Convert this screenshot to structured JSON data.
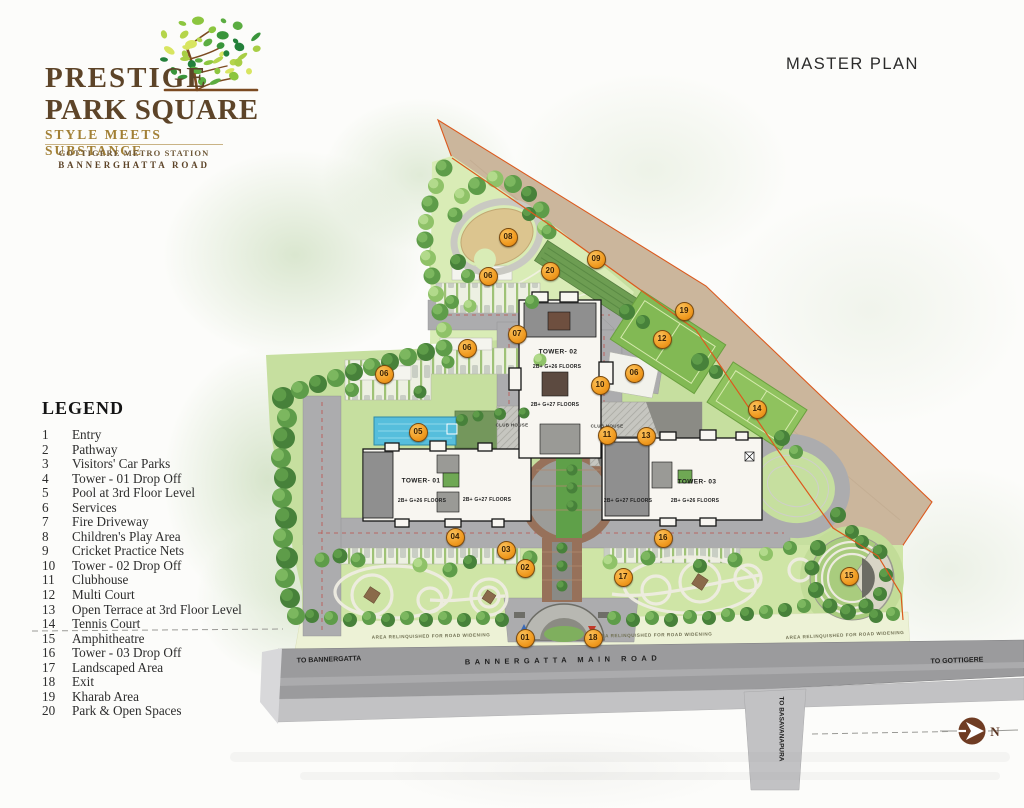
{
  "brand": {
    "line1": "PRESTIGE",
    "line2": "PARK SQUARE",
    "tagline": "STYLE MEETS SUBSTANCE",
    "sub1": "GOTTIGERE METRO STATION",
    "sub2": "BANNERGHATTA ROAD"
  },
  "page_title": "MASTER PLAN",
  "legend": {
    "title": "LEGEND",
    "items": [
      {
        "num": "1",
        "label": "Entry"
      },
      {
        "num": "2",
        "label": "Pathway"
      },
      {
        "num": "3",
        "label": "Visitors' Car Parks"
      },
      {
        "num": "4",
        "label": "Tower - 01 Drop Off"
      },
      {
        "num": "5",
        "label": "Pool at 3rd Floor Level"
      },
      {
        "num": "6",
        "label": "Services"
      },
      {
        "num": "7",
        "label": "Fire Driveway"
      },
      {
        "num": "8",
        "label": "Children's Play Area"
      },
      {
        "num": "9",
        "label": "Cricket Practice Nets"
      },
      {
        "num": "10",
        "label": "Tower - 02 Drop Off"
      },
      {
        "num": "11",
        "label": "Clubhouse"
      },
      {
        "num": "12",
        "label": "Multi Court"
      },
      {
        "num": "13",
        "label": "Open Terrace at 3rd Floor Level"
      },
      {
        "num": "14",
        "label": "Tennis Court"
      },
      {
        "num": "15",
        "label": "Amphitheatre"
      },
      {
        "num": "16",
        "label": "Tower - 03 Drop Off"
      },
      {
        "num": "17",
        "label": "Landscaped Area"
      },
      {
        "num": "18",
        "label": "Exit"
      },
      {
        "num": "19",
        "label": "Kharab Area"
      },
      {
        "num": "20",
        "label": "Park & Open Spaces"
      }
    ]
  },
  "map": {
    "towers": [
      {
        "name": "TOWER- 01",
        "floors_a": "2B+ G+26 FLOORS",
        "floors_b": "2B+ G+27 FLOORS"
      },
      {
        "name": "TOWER- 02",
        "floors_a": "2B+ G+26 FLOORS",
        "floors_b": "2B+ G+27 FLOORS"
      },
      {
        "name": "TOWER- 03",
        "floors_a": "2B+ G+27 FLOORS",
        "floors_b": "2B+ G+26 FLOORS"
      }
    ],
    "labels": {
      "club_house": "CLUB HOUSE",
      "road_widening": "AREA RELINQUISHED FOR ROAD WIDENING",
      "main_road": "BANNERGATTA MAIN ROAD",
      "to_bannergatta": "TO BANNERGATTA",
      "to_gottigere": "TO GOTTIGERE",
      "to_basavanapura": "TO BASAVANAPURA",
      "north": "N"
    },
    "markers": [
      {
        "num": "08",
        "x": 507,
        "y": 236
      },
      {
        "num": "06",
        "x": 487,
        "y": 275
      },
      {
        "num": "20",
        "x": 549,
        "y": 270
      },
      {
        "num": "09",
        "x": 595,
        "y": 258
      },
      {
        "num": "19",
        "x": 683,
        "y": 310
      },
      {
        "num": "12",
        "x": 661,
        "y": 338
      },
      {
        "num": "07",
        "x": 516,
        "y": 333
      },
      {
        "num": "06",
        "x": 466,
        "y": 347
      },
      {
        "num": "06",
        "x": 383,
        "y": 373
      },
      {
        "num": "06",
        "x": 633,
        "y": 372
      },
      {
        "num": "10",
        "x": 599,
        "y": 384
      },
      {
        "num": "14",
        "x": 756,
        "y": 408
      },
      {
        "num": "05",
        "x": 417,
        "y": 431
      },
      {
        "num": "11",
        "x": 606,
        "y": 434
      },
      {
        "num": "13",
        "x": 645,
        "y": 435
      },
      {
        "num": "04",
        "x": 454,
        "y": 536
      },
      {
        "num": "16",
        "x": 662,
        "y": 537
      },
      {
        "num": "03",
        "x": 505,
        "y": 549
      },
      {
        "num": "02",
        "x": 524,
        "y": 567
      },
      {
        "num": "17",
        "x": 622,
        "y": 576
      },
      {
        "num": "15",
        "x": 848,
        "y": 575
      },
      {
        "num": "01",
        "x": 524,
        "y": 637
      },
      {
        "num": "18",
        "x": 592,
        "y": 637
      }
    ],
    "colors": {
      "marker_orange": "#F59B2C",
      "boundary_orange": "#DC5A1E",
      "kharab_tan": "#CBB69C",
      "pool_blue": "#56BEDC",
      "court_green": "#84BA55",
      "brand_brown": "#5D4428",
      "brand_gold": "#A28036"
    }
  }
}
